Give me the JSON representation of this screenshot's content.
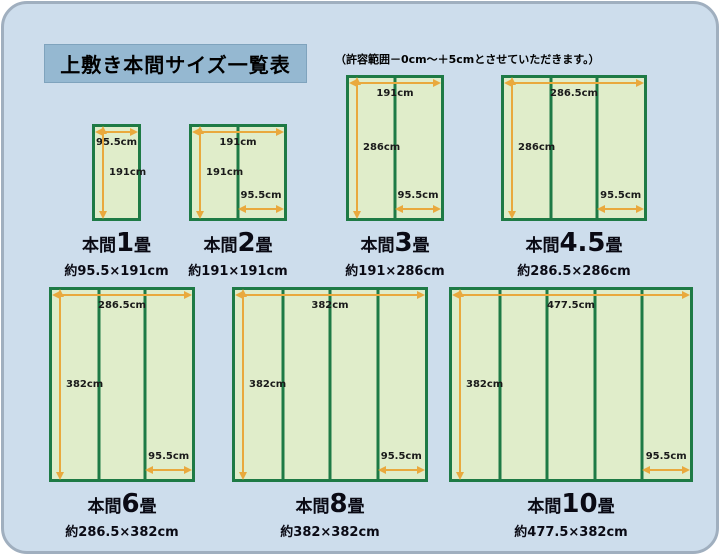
{
  "page": {
    "title": "上敷き本間サイズ一覧表",
    "note": "（許容範囲－0cm～＋5cmとさせていただきます。）"
  },
  "colors": {
    "page_background": "#ffffff",
    "panel_background": "#cdddec",
    "panel_border": "#a0afbf",
    "title_box_background": "#95b8d1",
    "mat_fill": "#e0edca",
    "mat_border_green": "#1e7a45",
    "dimension_arrow_orange": "#e9a93d",
    "text_color": "#0a0a14"
  },
  "diagrams": [
    {
      "id": "honma-1jo",
      "name_prefix": "本間",
      "name_num": "1",
      "name_suffix": "畳",
      "size_text": "約95.5×191cm",
      "width_label": "95.5cm",
      "height_label": "191cm",
      "width_cm": 95.5,
      "height_cm": 191,
      "columns": 1
    },
    {
      "id": "honma-2jo",
      "name_prefix": "本間",
      "name_num": "2",
      "name_suffix": "畳",
      "size_text": "約191×191cm",
      "width_label": "191cm",
      "height_label": "191cm",
      "unit_width_label": "95.5cm",
      "width_cm": 191,
      "height_cm": 191,
      "unit_width_cm": 95.5,
      "columns": 2
    },
    {
      "id": "honma-3jo",
      "name_prefix": "本間",
      "name_num": "3",
      "name_suffix": "畳",
      "size_text": "約191×286cm",
      "width_label": "191cm",
      "height_label": "286cm",
      "unit_width_label": "95.5cm",
      "width_cm": 191,
      "height_cm": 286,
      "unit_width_cm": 95.5,
      "columns": 2
    },
    {
      "id": "honma-4-5jo",
      "name_prefix": "本間",
      "name_num": "4.5",
      "name_suffix": "畳",
      "size_text": "約286.5×286cm",
      "width_label": "286.5cm",
      "height_label": "286cm",
      "unit_width_label": "95.5cm",
      "width_cm": 286.5,
      "height_cm": 286,
      "unit_width_cm": 95.5,
      "columns": 3
    },
    {
      "id": "honma-6jo",
      "name_prefix": "本間",
      "name_num": "6",
      "name_suffix": "畳",
      "size_text": "約286.5×382cm",
      "width_label": "286.5cm",
      "height_label": "382cm",
      "unit_width_label": "95.5cm",
      "width_cm": 286.5,
      "height_cm": 382,
      "unit_width_cm": 95.5,
      "columns": 3
    },
    {
      "id": "honma-8jo",
      "name_prefix": "本間",
      "name_num": "8",
      "name_suffix": "畳",
      "size_text": "約382×382cm",
      "width_label": "382cm",
      "height_label": "382cm",
      "unit_width_label": "95.5cm",
      "width_cm": 382,
      "height_cm": 382,
      "unit_width_cm": 95.5,
      "columns": 4
    },
    {
      "id": "honma-10jo",
      "name_prefix": "本間",
      "name_num": "10",
      "name_suffix": "畳",
      "size_text": "約477.5×382cm",
      "width_label": "477.5cm",
      "height_label": "382cm",
      "unit_width_label": "95.5cm",
      "width_cm": 477.5,
      "height_cm": 382,
      "unit_width_cm": 95.5,
      "columns": 5
    }
  ]
}
